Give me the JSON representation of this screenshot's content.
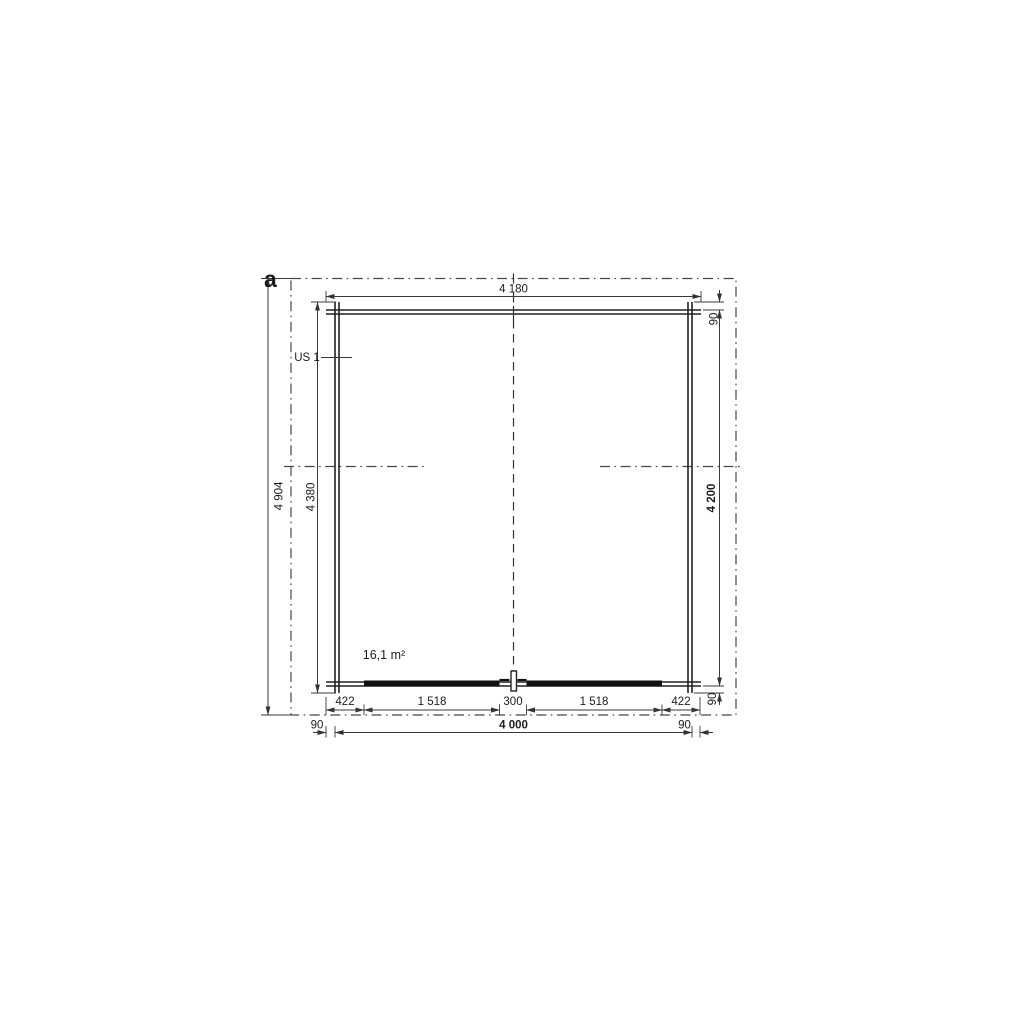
{
  "plan": {
    "section_label": "a",
    "room_label": "US 1",
    "area_label": "16,1 m²",
    "dims": {
      "top_overall": "4 180",
      "left_outer": "4 904",
      "left_wall_total": "4 380",
      "right_wall": "4 200",
      "right_top_offset": "90",
      "right_bottom_offset": "90",
      "bottom_segments": [
        "422",
        "1 518",
        "300",
        "1 518",
        "422"
      ],
      "bottom_left_offset": "90",
      "bottom_width": "4 000",
      "bottom_right_offset": "90"
    }
  }
}
